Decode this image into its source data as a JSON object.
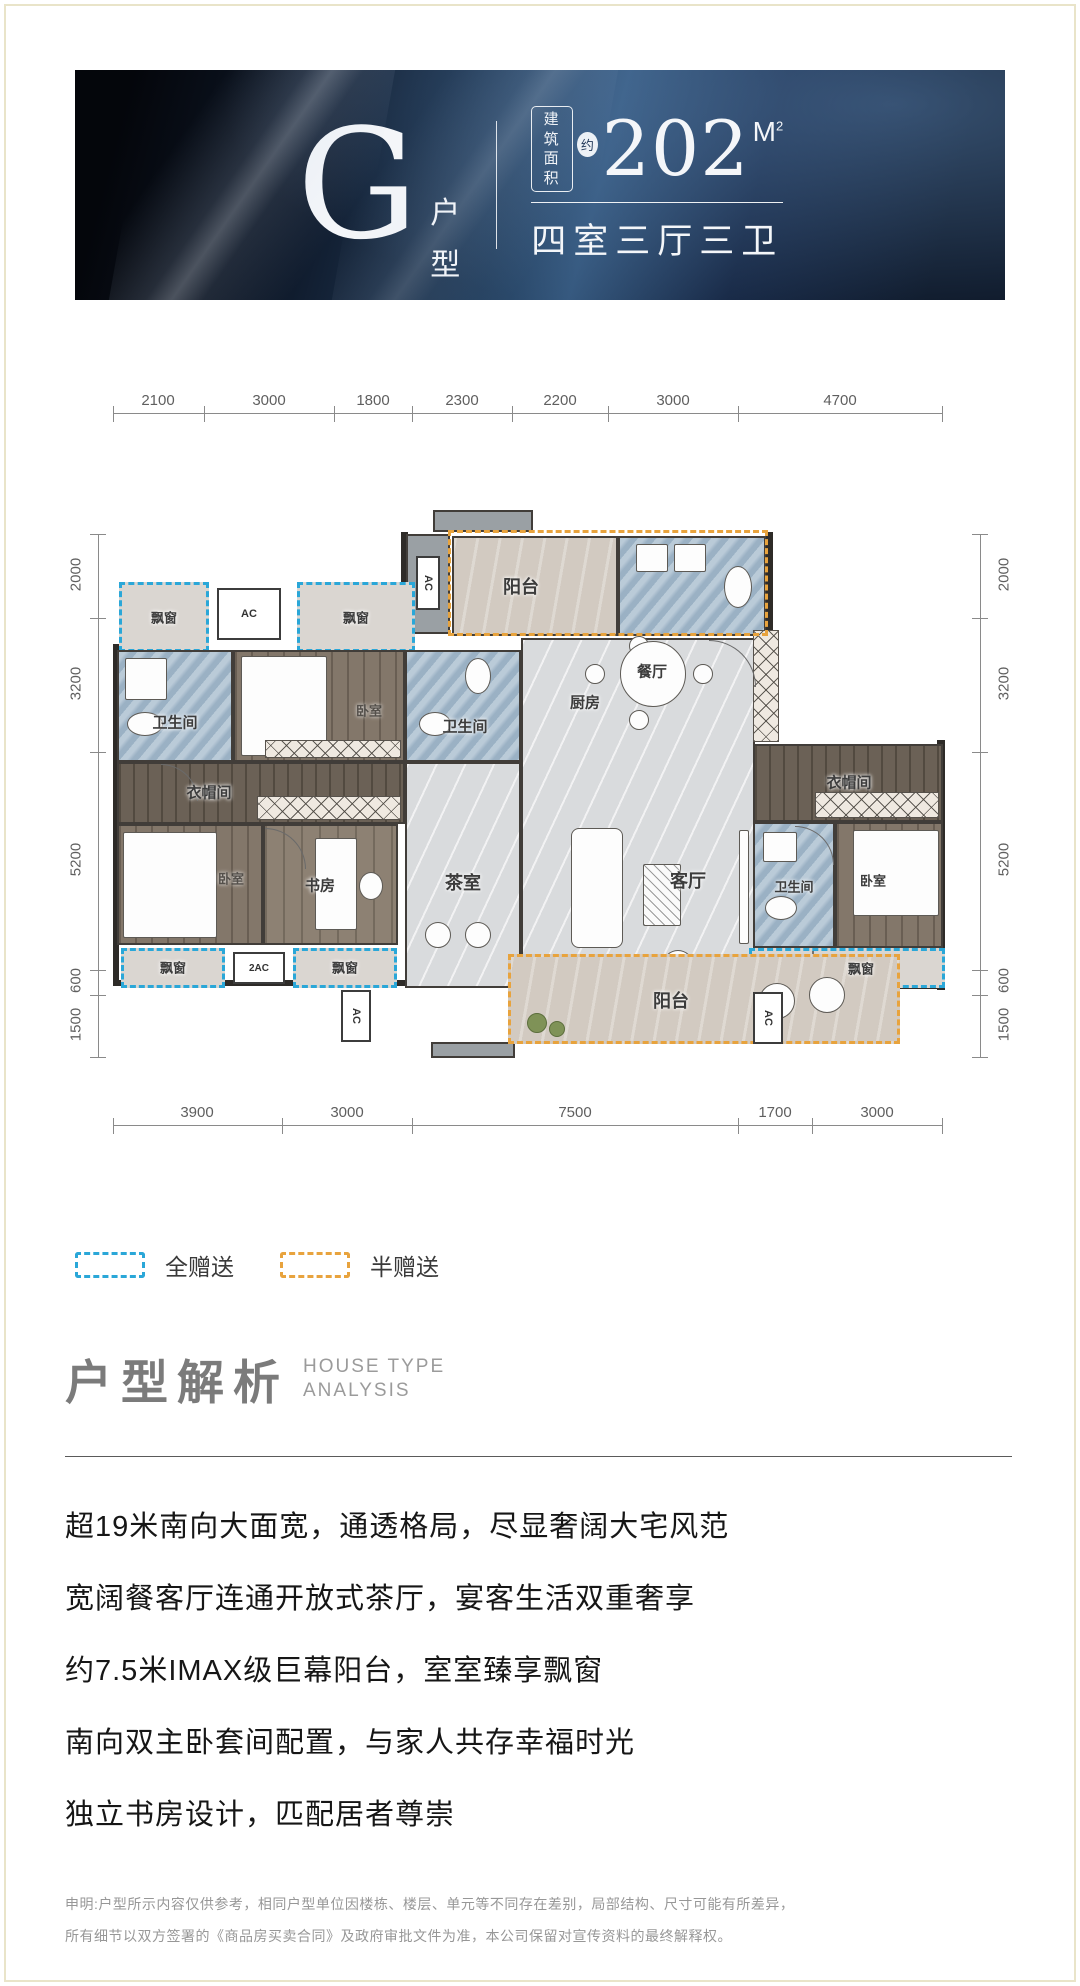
{
  "colors": {
    "banner_navy": "#16273f",
    "full_gift_dash": "#2aa7d8",
    "half_gift_dash": "#e8a33d"
  },
  "header": {
    "type_letter": "G",
    "type_suffix": [
      "户",
      "型"
    ],
    "area_prefix_line1": "建筑",
    "area_prefix_line2": "面积",
    "area_approx": "约",
    "area_value": "202",
    "area_unit": "M",
    "area_unit_sup": "2",
    "rooms_text": "四室三厅三卫"
  },
  "floorplan": {
    "dims_top": [
      "2100",
      "3000",
      "1800",
      "2300",
      "2200",
      "3000",
      "4700"
    ],
    "dims_bottom": [
      "3900",
      "3000",
      "7500",
      "1700",
      "3000"
    ],
    "dims_left": [
      "2000",
      "3200",
      "5200",
      "600",
      "1500"
    ],
    "dims_right": [
      "2000",
      "3200",
      "5200",
      "600",
      "1500"
    ],
    "labels": {
      "balcony": "阳台",
      "bathroom": "卫生间",
      "kitchen": "厨房",
      "dining": "餐厅",
      "tea_room": "茶室",
      "living": "客厅",
      "study": "书房",
      "bedroom": "卧室",
      "cloakroom": "衣帽间",
      "bay_window": "飘窗",
      "ac": "AC",
      "ac2": "2AC"
    }
  },
  "legend": {
    "full_gift": "全赠送",
    "half_gift": "半赠送"
  },
  "analysis": {
    "title": "户型解析",
    "subtitle_line1": "HOUSE TYPE",
    "subtitle_line2": "ANALYSIS",
    "points": [
      "超19米南向大面宽，通透格局，尽显奢阔大宅风范",
      "宽阔餐客厅连通开放式茶厅，宴客生活双重奢享",
      "约7.5米IMAX级巨幕阳台，室室臻享飘窗",
      "南向双主卧套间配置，与家人共存幸福时光",
      "独立书房设计，匹配居者尊崇"
    ]
  },
  "disclaimer": {
    "line1": "申明:户型所示内容仅供参考，相同户型单位因楼栋、楼层、单元等不同存在差别，局部结构、尺寸可能有所差异，",
    "line2": "所有细节以双方签署的《商品房买卖合同》及政府审批文件为准，本公司保留对宣传资料的最终解释权。"
  }
}
